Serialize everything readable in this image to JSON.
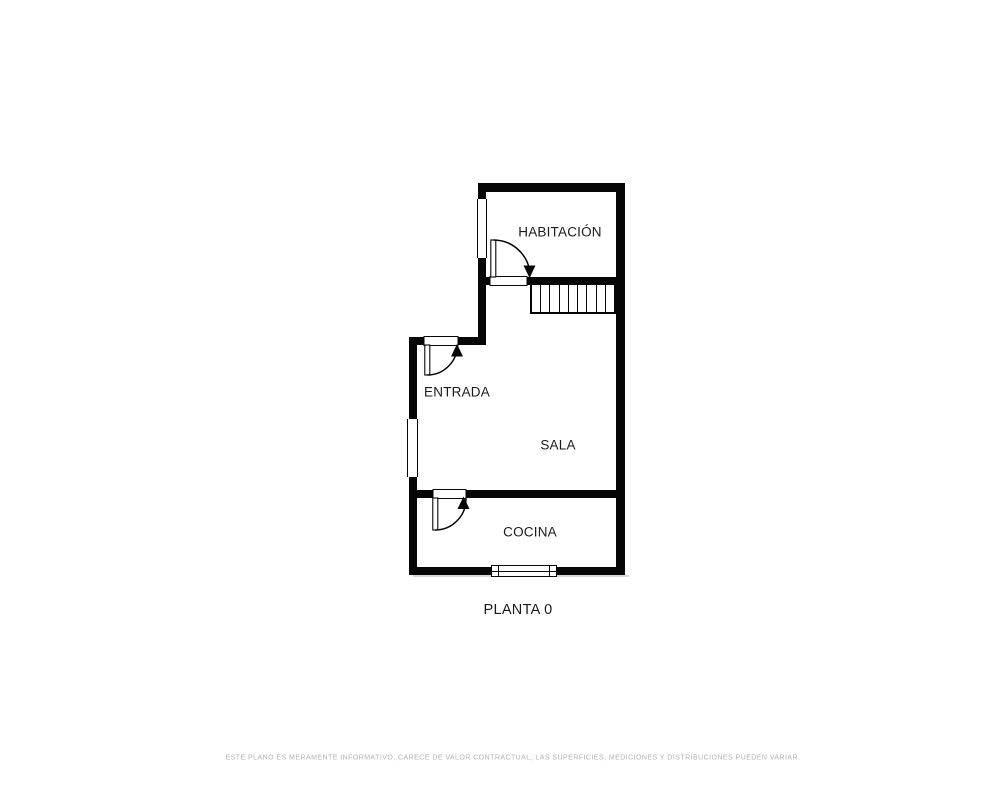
{
  "plan": {
    "title": "PLANTA 0",
    "rooms": [
      {
        "id": "habitacion",
        "label": "HABITACIÓN"
      },
      {
        "id": "entrada",
        "label": "ENTRADA"
      },
      {
        "id": "sala",
        "label": "SALA"
      },
      {
        "id": "cocina",
        "label": "COCINA"
      }
    ],
    "floor_label": "PLANTA 0",
    "disclaimer": "ESTE PLANO ES MERAMENTE INFORMATIVO, CARECE DE VALOR CONTRACTUAL, LAS SUPERFICIES, MEDICIONES Y DISTRIBUCIONES PUEDEN VARIAR.",
    "features": {
      "stairs_treads": 9,
      "doors": 3,
      "windows": 3
    },
    "colors": {
      "wall": "#060606",
      "text": "#1b1b1b",
      "disclaimer_text": "#b2b2b2",
      "background": "#ffffff"
    }
  }
}
